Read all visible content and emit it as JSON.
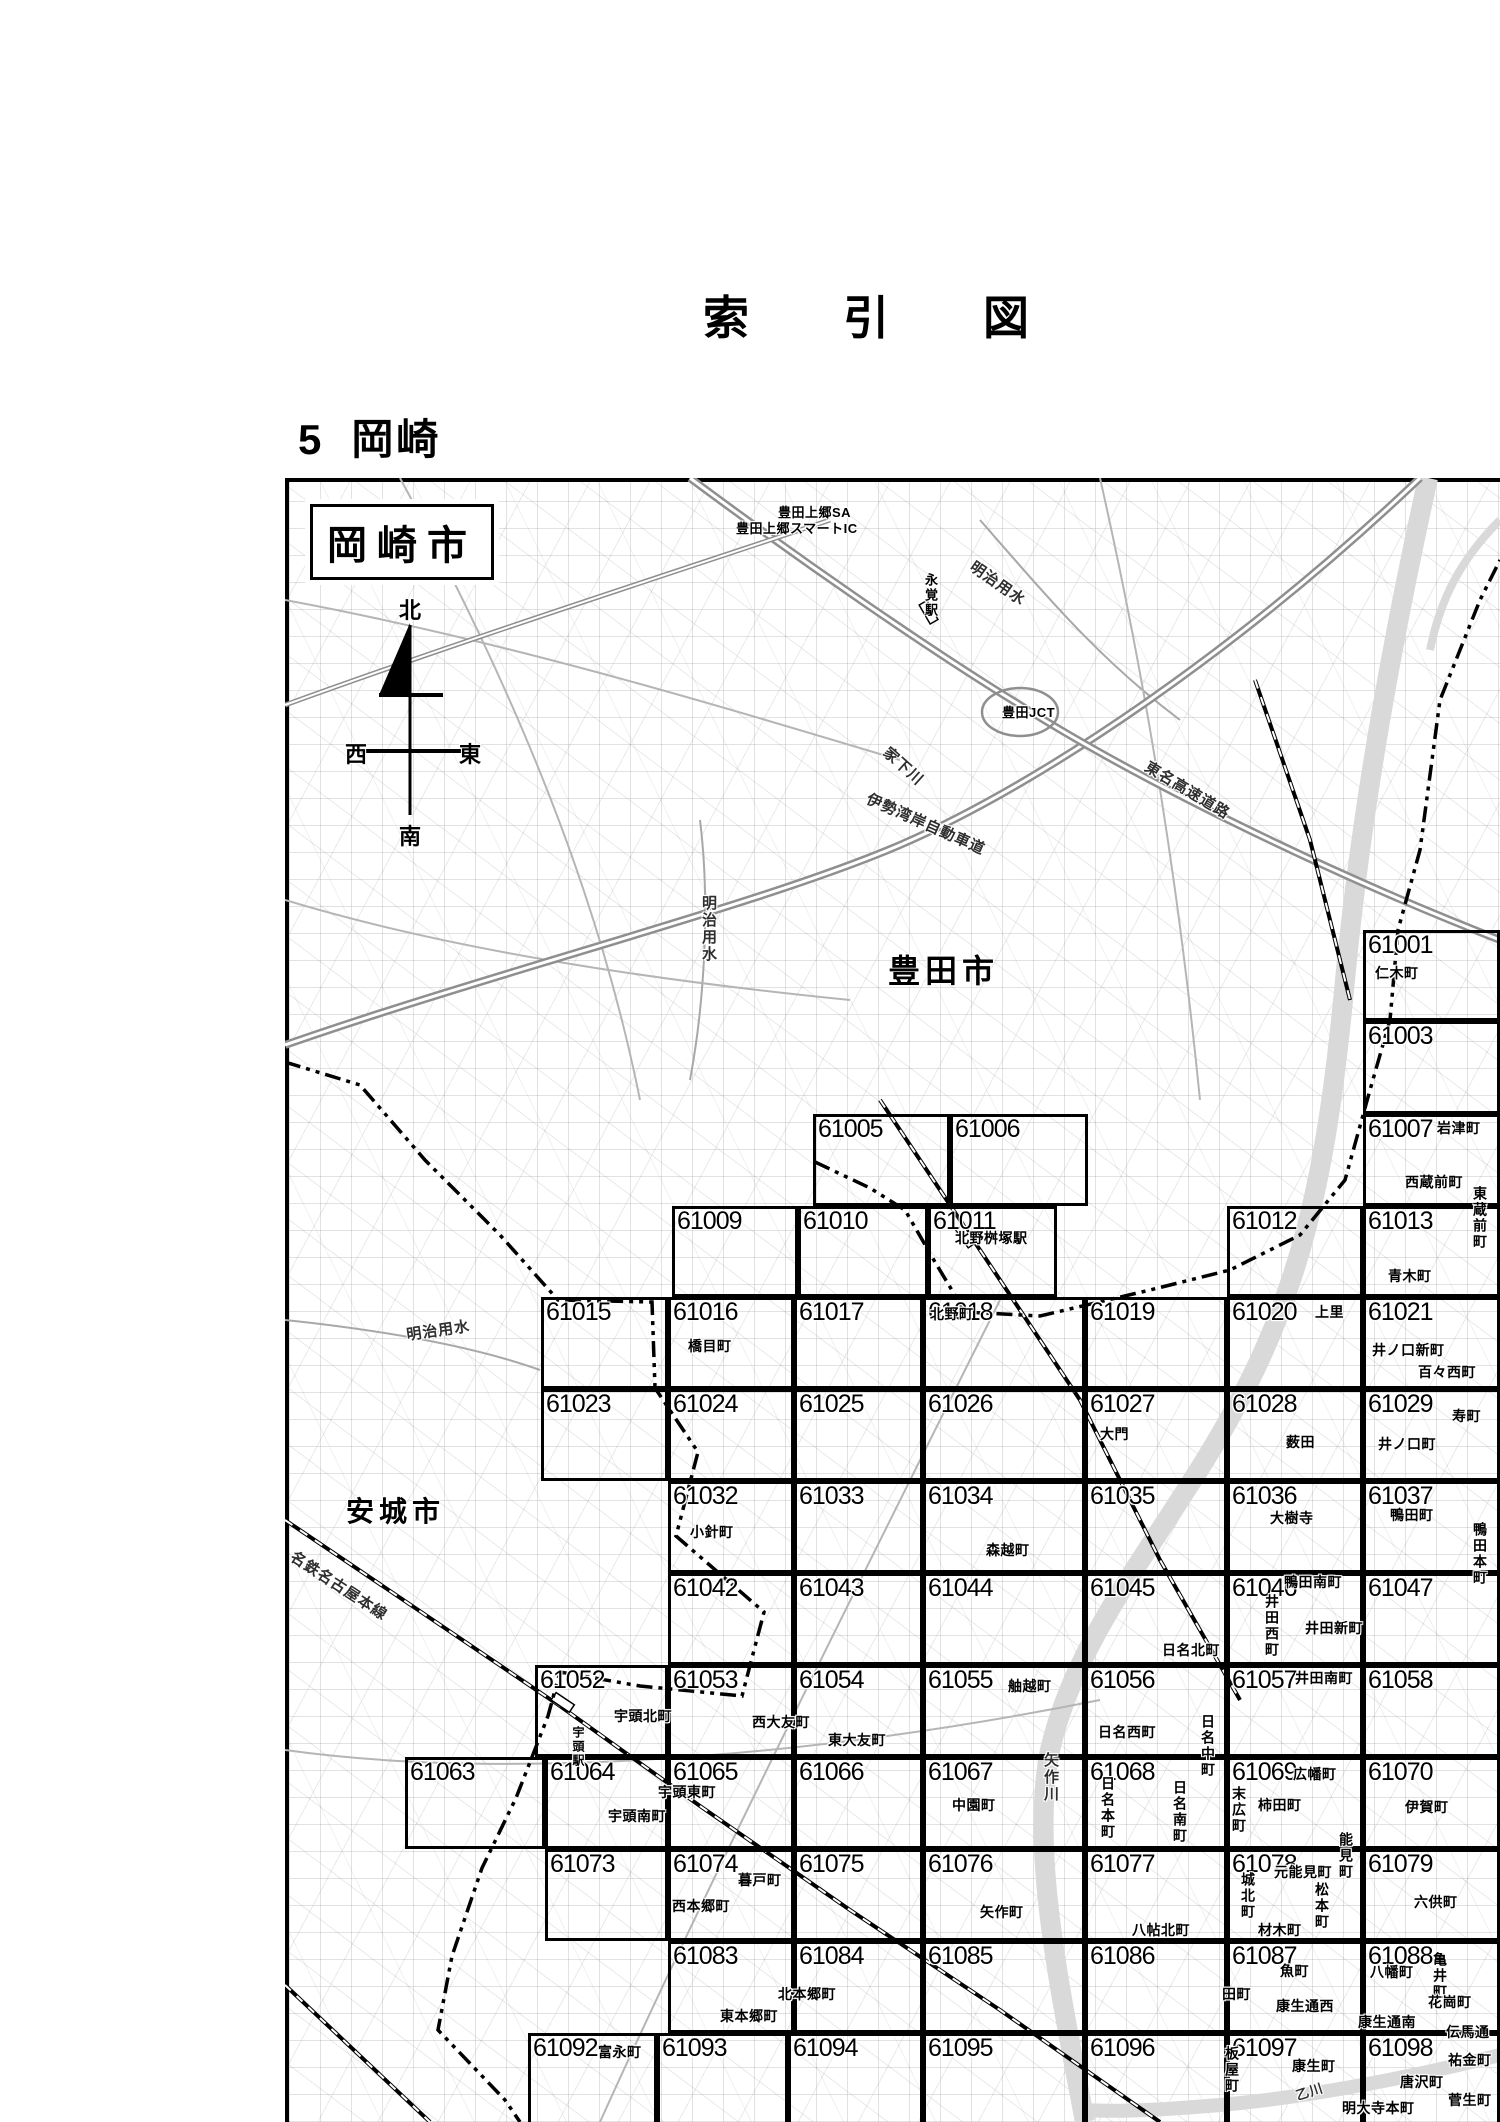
{
  "page": {
    "title": "索　引　図",
    "section_number": "5",
    "section_name": "岡崎"
  },
  "colors": {
    "frame": "#000000",
    "road": "#b9b9b9",
    "river": "#d9d9d9",
    "halo": "#ffffff"
  },
  "map": {
    "city_box_label": "岡崎市",
    "compass": {
      "north": "北",
      "south": "南",
      "east": "東",
      "west": "西"
    },
    "city_labels": [
      {
        "text": "豊田市",
        "x": 888,
        "y": 946,
        "size": 32
      },
      {
        "text": "安城市",
        "x": 346,
        "y": 1490,
        "size": 28
      }
    ],
    "feature_labels": [
      {
        "text": "明治用水",
        "x": 978,
        "y": 556,
        "rotate": 35
      },
      {
        "text": "家下川",
        "x": 893,
        "y": 742,
        "rotate": 42
      },
      {
        "text": "伊勢湾岸自動車道",
        "x": 872,
        "y": 788,
        "rotate": 24
      },
      {
        "text": "東名高速道路",
        "x": 1152,
        "y": 756,
        "rotate": 31
      },
      {
        "text": "明治用水",
        "x": 698,
        "y": 895,
        "vertical": true
      },
      {
        "text": "明治用水",
        "x": 405,
        "y": 1324,
        "rotate": -8
      },
      {
        "text": "名鉄名古屋本線",
        "x": 298,
        "y": 1546,
        "rotate": 33
      },
      {
        "text": "矢作川",
        "x": 1040,
        "y": 1752,
        "vertical": true
      },
      {
        "text": "乙川",
        "x": 1293,
        "y": 2086,
        "rotate": -18,
        "size": 13
      }
    ],
    "place_labels": [
      {
        "text": "仁木町",
        "x": 1375,
        "y": 963
      },
      {
        "text": "岩津町",
        "x": 1437,
        "y": 1118
      },
      {
        "text": "西蔵前町",
        "x": 1405,
        "y": 1172
      },
      {
        "text": "東蔵前町",
        "x": 1470,
        "y": 1186,
        "vertical": true
      },
      {
        "text": "青木町",
        "x": 1388,
        "y": 1266
      },
      {
        "text": "北野桝塚駅",
        "x": 955,
        "y": 1228
      },
      {
        "text": "北野町",
        "x": 930,
        "y": 1304
      },
      {
        "text": "上里",
        "x": 1315,
        "y": 1302
      },
      {
        "text": "井ノ口新町",
        "x": 1372,
        "y": 1340
      },
      {
        "text": "百々西町",
        "x": 1418,
        "y": 1362
      },
      {
        "text": "橋目町",
        "x": 688,
        "y": 1336
      },
      {
        "text": "大門",
        "x": 1100,
        "y": 1424
      },
      {
        "text": "薮田",
        "x": 1286,
        "y": 1432
      },
      {
        "text": "寿町",
        "x": 1452,
        "y": 1406
      },
      {
        "text": "井ノ口町",
        "x": 1378,
        "y": 1434
      },
      {
        "text": "小針町",
        "x": 690,
        "y": 1522
      },
      {
        "text": "森越町",
        "x": 986,
        "y": 1540
      },
      {
        "text": "大樹寺",
        "x": 1270,
        "y": 1508
      },
      {
        "text": "鴨田町",
        "x": 1390,
        "y": 1505
      },
      {
        "text": "鴨田本町",
        "x": 1470,
        "y": 1522,
        "vertical": true
      },
      {
        "text": "鴨田南町",
        "x": 1284,
        "y": 1572
      },
      {
        "text": "井田西町",
        "x": 1262,
        "y": 1594,
        "vertical": true
      },
      {
        "text": "井田新町",
        "x": 1305,
        "y": 1618
      },
      {
        "text": "日名北町",
        "x": 1162,
        "y": 1640
      },
      {
        "text": "舳越町",
        "x": 1008,
        "y": 1676
      },
      {
        "text": "井田南町",
        "x": 1295,
        "y": 1668
      },
      {
        "text": "宇頭北町",
        "x": 614,
        "y": 1706
      },
      {
        "text": "西大友町",
        "x": 752,
        "y": 1712
      },
      {
        "text": "東大友町",
        "x": 828,
        "y": 1730
      },
      {
        "text": "日名西町",
        "x": 1098,
        "y": 1722
      },
      {
        "text": "日名中町",
        "x": 1198,
        "y": 1714,
        "vertical": true
      },
      {
        "text": "宇頭駅",
        "x": 570,
        "y": 1726,
        "vertical": true,
        "size": 12
      },
      {
        "text": "宇頭東町",
        "x": 658,
        "y": 1782
      },
      {
        "text": "宇頭南町",
        "x": 608,
        "y": 1806
      },
      {
        "text": "中園町",
        "x": 952,
        "y": 1795
      },
      {
        "text": "広幡町",
        "x": 1293,
        "y": 1764
      },
      {
        "text": "末広町",
        "x": 1229,
        "y": 1786,
        "vertical": true
      },
      {
        "text": "柿田町",
        "x": 1258,
        "y": 1795
      },
      {
        "text": "伊賀町",
        "x": 1405,
        "y": 1797
      },
      {
        "text": "日名本町",
        "x": 1098,
        "y": 1776,
        "vertical": true
      },
      {
        "text": "日名南町",
        "x": 1170,
        "y": 1780,
        "vertical": true
      },
      {
        "text": "能見町",
        "x": 1336,
        "y": 1832,
        "vertical": true
      },
      {
        "text": "元能見町",
        "x": 1274,
        "y": 1862
      },
      {
        "text": "城北町",
        "x": 1238,
        "y": 1872,
        "vertical": true
      },
      {
        "text": "松本町",
        "x": 1312,
        "y": 1882,
        "vertical": true
      },
      {
        "text": "材木町",
        "x": 1258,
        "y": 1920
      },
      {
        "text": "六供町",
        "x": 1414,
        "y": 1892
      },
      {
        "text": "八帖北町",
        "x": 1132,
        "y": 1920
      },
      {
        "text": "暮戸町",
        "x": 738,
        "y": 1870
      },
      {
        "text": "西本郷町",
        "x": 672,
        "y": 1896
      },
      {
        "text": "矢作町",
        "x": 980,
        "y": 1902
      },
      {
        "text": "北本郷町",
        "x": 778,
        "y": 1984
      },
      {
        "text": "東本郷町",
        "x": 720,
        "y": 2006
      },
      {
        "text": "魚町",
        "x": 1280,
        "y": 1961
      },
      {
        "text": "田町",
        "x": 1222,
        "y": 1984
      },
      {
        "text": "康生通西",
        "x": 1276,
        "y": 1996
      },
      {
        "text": "八幡町",
        "x": 1370,
        "y": 1962
      },
      {
        "text": "亀井町",
        "x": 1430,
        "y": 1952,
        "vertical": true
      },
      {
        "text": "花崗町",
        "x": 1428,
        "y": 1992
      },
      {
        "text": "康生通南",
        "x": 1358,
        "y": 2012
      },
      {
        "text": "伝馬通",
        "x": 1446,
        "y": 2022
      },
      {
        "text": "板屋町",
        "x": 1222,
        "y": 2046,
        "vertical": true
      },
      {
        "text": "康生町",
        "x": 1292,
        "y": 2056
      },
      {
        "text": "祐金町",
        "x": 1448,
        "y": 2050
      },
      {
        "text": "唐沢町",
        "x": 1400,
        "y": 2072
      },
      {
        "text": "菅生町",
        "x": 1448,
        "y": 2090
      },
      {
        "text": "明大寺本町",
        "x": 1342,
        "y": 2098
      },
      {
        "text": "富永町",
        "x": 598,
        "y": 2042
      },
      {
        "text": "豊田上郷SA",
        "x": 778,
        "y": 502,
        "size": 13
      },
      {
        "text": "豊田上郷スマートIC",
        "x": 736,
        "y": 518,
        "size": 13
      },
      {
        "text": "豊田JCT",
        "x": 1002,
        "y": 702,
        "size": 13
      },
      {
        "text": "永覚駅",
        "x": 921,
        "y": 573,
        "vertical": true,
        "size": 13
      }
    ],
    "sheets": [
      {
        "num": "61001",
        "x": 1363,
        "y": 930,
        "w": 137,
        "h": 91
      },
      {
        "num": "61003",
        "x": 1363,
        "y": 1021,
        "w": 137,
        "h": 93
      },
      {
        "num": "61005",
        "x": 813,
        "y": 1114,
        "w": 137,
        "h": 92
      },
      {
        "num": "61006",
        "x": 950,
        "y": 1114,
        "w": 138,
        "h": 92
      },
      {
        "num": "61007",
        "x": 1363,
        "y": 1114,
        "w": 137,
        "h": 92
      },
      {
        "num": "61009",
        "x": 672,
        "y": 1206,
        "w": 126,
        "h": 91
      },
      {
        "num": "61010",
        "x": 798,
        "y": 1206,
        "w": 130,
        "h": 91
      },
      {
        "num": "61011",
        "x": 928,
        "y": 1206,
        "w": 129,
        "h": 91
      },
      {
        "num": "61012",
        "x": 1227,
        "y": 1206,
        "w": 136,
        "h": 91
      },
      {
        "num": "61013",
        "x": 1363,
        "y": 1206,
        "w": 137,
        "h": 91
      },
      {
        "num": "61015",
        "x": 541,
        "y": 1297,
        "w": 127,
        "h": 92
      },
      {
        "num": "61016",
        "x": 668,
        "y": 1297,
        "w": 126,
        "h": 92
      },
      {
        "num": "61017",
        "x": 794,
        "y": 1297,
        "w": 129,
        "h": 92
      },
      {
        "num": "61018",
        "x": 923,
        "y": 1297,
        "w": 162,
        "h": 92
      },
      {
        "num": "61019",
        "x": 1085,
        "y": 1297,
        "w": 142,
        "h": 92
      },
      {
        "num": "61020",
        "x": 1227,
        "y": 1297,
        "w": 136,
        "h": 92
      },
      {
        "num": "61021",
        "x": 1363,
        "y": 1297,
        "w": 137,
        "h": 92
      },
      {
        "num": "61023",
        "x": 541,
        "y": 1389,
        "w": 127,
        "h": 92
      },
      {
        "num": "61024",
        "x": 668,
        "y": 1389,
        "w": 126,
        "h": 92
      },
      {
        "num": "61025",
        "x": 794,
        "y": 1389,
        "w": 129,
        "h": 92
      },
      {
        "num": "61026",
        "x": 923,
        "y": 1389,
        "w": 162,
        "h": 92
      },
      {
        "num": "61027",
        "x": 1085,
        "y": 1389,
        "w": 142,
        "h": 92
      },
      {
        "num": "61028",
        "x": 1227,
        "y": 1389,
        "w": 136,
        "h": 92
      },
      {
        "num": "61029",
        "x": 1363,
        "y": 1389,
        "w": 137,
        "h": 92
      },
      {
        "num": "61032",
        "x": 668,
        "y": 1481,
        "w": 126,
        "h": 92
      },
      {
        "num": "61033",
        "x": 794,
        "y": 1481,
        "w": 129,
        "h": 92
      },
      {
        "num": "61034",
        "x": 923,
        "y": 1481,
        "w": 162,
        "h": 92
      },
      {
        "num": "61035",
        "x": 1085,
        "y": 1481,
        "w": 142,
        "h": 92
      },
      {
        "num": "61036",
        "x": 1227,
        "y": 1481,
        "w": 136,
        "h": 92
      },
      {
        "num": "61037",
        "x": 1363,
        "y": 1481,
        "w": 137,
        "h": 92
      },
      {
        "num": "61042",
        "x": 668,
        "y": 1573,
        "w": 126,
        "h": 92
      },
      {
        "num": "61043",
        "x": 794,
        "y": 1573,
        "w": 129,
        "h": 92
      },
      {
        "num": "61044",
        "x": 923,
        "y": 1573,
        "w": 162,
        "h": 92
      },
      {
        "num": "61045",
        "x": 1085,
        "y": 1573,
        "w": 142,
        "h": 92
      },
      {
        "num": "61046",
        "x": 1227,
        "y": 1573,
        "w": 136,
        "h": 92
      },
      {
        "num": "61047",
        "x": 1363,
        "y": 1573,
        "w": 137,
        "h": 92
      },
      {
        "num": "61052",
        "x": 535,
        "y": 1665,
        "w": 133,
        "h": 92
      },
      {
        "num": "61053",
        "x": 668,
        "y": 1665,
        "w": 126,
        "h": 92
      },
      {
        "num": "61054",
        "x": 794,
        "y": 1665,
        "w": 129,
        "h": 92
      },
      {
        "num": "61055",
        "x": 923,
        "y": 1665,
        "w": 162,
        "h": 92
      },
      {
        "num": "61056",
        "x": 1085,
        "y": 1665,
        "w": 142,
        "h": 92
      },
      {
        "num": "61057",
        "x": 1227,
        "y": 1665,
        "w": 136,
        "h": 92
      },
      {
        "num": "61058",
        "x": 1363,
        "y": 1665,
        "w": 137,
        "h": 92
      },
      {
        "num": "61063",
        "x": 405,
        "y": 1757,
        "w": 140,
        "h": 92
      },
      {
        "num": "61064",
        "x": 545,
        "y": 1757,
        "w": 123,
        "h": 92
      },
      {
        "num": "61065",
        "x": 668,
        "y": 1757,
        "w": 126,
        "h": 92
      },
      {
        "num": "61066",
        "x": 794,
        "y": 1757,
        "w": 129,
        "h": 92
      },
      {
        "num": "61067",
        "x": 923,
        "y": 1757,
        "w": 162,
        "h": 92
      },
      {
        "num": "61068",
        "x": 1085,
        "y": 1757,
        "w": 142,
        "h": 92
      },
      {
        "num": "61069",
        "x": 1227,
        "y": 1757,
        "w": 136,
        "h": 92
      },
      {
        "num": "61070",
        "x": 1363,
        "y": 1757,
        "w": 137,
        "h": 92
      },
      {
        "num": "61073",
        "x": 545,
        "y": 1849,
        "w": 123,
        "h": 92
      },
      {
        "num": "61074",
        "x": 668,
        "y": 1849,
        "w": 126,
        "h": 92
      },
      {
        "num": "61075",
        "x": 794,
        "y": 1849,
        "w": 129,
        "h": 92
      },
      {
        "num": "61076",
        "x": 923,
        "y": 1849,
        "w": 162,
        "h": 92
      },
      {
        "num": "61077",
        "x": 1085,
        "y": 1849,
        "w": 142,
        "h": 92
      },
      {
        "num": "61078",
        "x": 1227,
        "y": 1849,
        "w": 136,
        "h": 92
      },
      {
        "num": "61079",
        "x": 1363,
        "y": 1849,
        "w": 137,
        "h": 92
      },
      {
        "num": "61083",
        "x": 668,
        "y": 1941,
        "w": 126,
        "h": 92
      },
      {
        "num": "61084",
        "x": 794,
        "y": 1941,
        "w": 129,
        "h": 92
      },
      {
        "num": "61085",
        "x": 923,
        "y": 1941,
        "w": 162,
        "h": 92
      },
      {
        "num": "61086",
        "x": 1085,
        "y": 1941,
        "w": 142,
        "h": 92
      },
      {
        "num": "61087",
        "x": 1227,
        "y": 1941,
        "w": 136,
        "h": 92
      },
      {
        "num": "61088",
        "x": 1363,
        "y": 1941,
        "w": 137,
        "h": 92
      },
      {
        "num": "61092",
        "x": 528,
        "y": 2033,
        "w": 129,
        "h": 92
      },
      {
        "num": "61093",
        "x": 657,
        "y": 2033,
        "w": 131,
        "h": 92
      },
      {
        "num": "61094",
        "x": 788,
        "y": 2033,
        "w": 135,
        "h": 92
      },
      {
        "num": "61095",
        "x": 923,
        "y": 2033,
        "w": 162,
        "h": 92
      },
      {
        "num": "61096",
        "x": 1085,
        "y": 2033,
        "w": 142,
        "h": 92
      },
      {
        "num": "61097",
        "x": 1227,
        "y": 2033,
        "w": 136,
        "h": 92
      },
      {
        "num": "61098",
        "x": 1363,
        "y": 2033,
        "w": 137,
        "h": 92
      }
    ]
  }
}
